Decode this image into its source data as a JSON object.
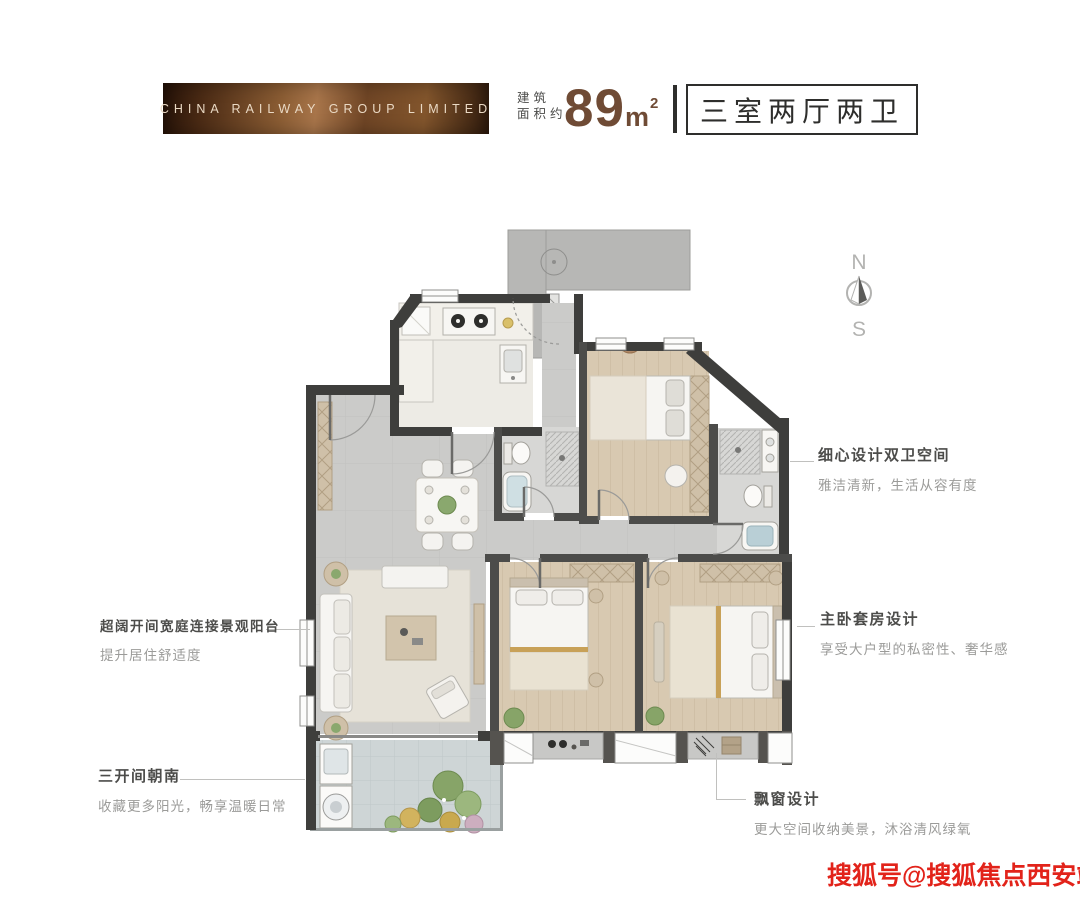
{
  "header": {
    "brand": "CHINA RAILWAY GROUP LIMITED",
    "area_label_line1": "建筑",
    "area_label_line2": "面积约",
    "area_value": "89",
    "area_unit": "m",
    "area_unit_sup": "2",
    "layout_type": "三室两厅两卫"
  },
  "compass": {
    "north": "N",
    "south": "S"
  },
  "callouts": {
    "dual_bath": {
      "title": "细心设计双卫空间",
      "subtitle": "雅洁清新，生活从容有度"
    },
    "master": {
      "title": "主卧套房设计",
      "subtitle": "享受大户型的私密性、奢华感"
    },
    "balcony": {
      "title": "超阔开间宽庭连接景观阳台",
      "subtitle": "提升居住舒适度"
    },
    "south_facing": {
      "title": "三开间朝南",
      "subtitle": "收藏更多阳光，畅享温暖日常"
    },
    "bay_window": {
      "title": "飘窗设计",
      "subtitle": "更大空间收纳美景，沐浴清风绿氧"
    }
  },
  "watermark": "搜狐号@搜狐焦点西安站",
  "colors": {
    "accent_brown": "#6F4B35",
    "banner_dark": "#3A2010",
    "wall_dark": "#3E3E3C",
    "watermark_red": "#E2231A"
  }
}
